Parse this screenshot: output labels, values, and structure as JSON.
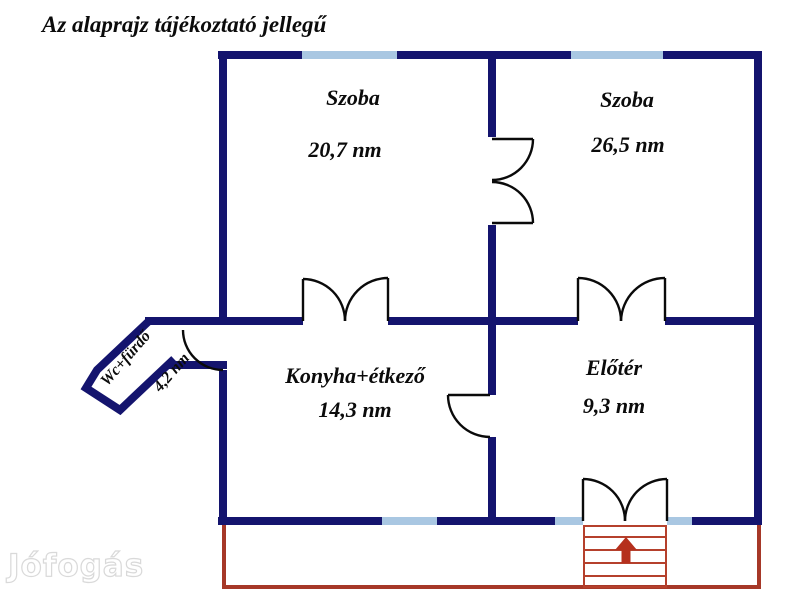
{
  "title": "Az alaprajz tájékoztató jellegű",
  "watermark": "Jófogás",
  "rooms": [
    {
      "name": "Szoba",
      "area": "20,7 nm"
    },
    {
      "name": "Szoba",
      "area": "26,5 nm"
    },
    {
      "name": "Konyha+étkező",
      "area": "14,3 nm"
    },
    {
      "name": "Előtér",
      "area": "9,3 nm"
    },
    {
      "name": "Wc+fürdő",
      "area": "4,2 nm"
    }
  ],
  "colors": {
    "wall": "#14146e",
    "window": "#a9c7e2",
    "door": "#0a0a0a",
    "terrace": "#a63828",
    "stairs": "#b5402c",
    "arrow": "#b5301d",
    "text": "#0b0b0b",
    "watermark_outline": "#d9d9d9"
  }
}
